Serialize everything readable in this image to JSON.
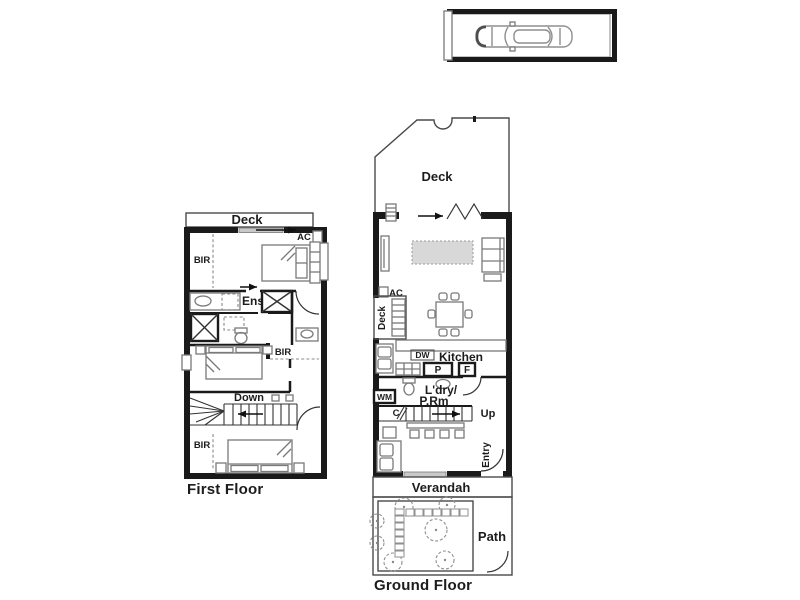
{
  "colors": {
    "wall": "#1a1a1a",
    "outline": "#4a4a4a",
    "furn": "#7a7a7a",
    "rug": "#d8d8d8",
    "slider": "#c9c9c9",
    "text": "#1c1c1c",
    "bg": "#ffffff"
  },
  "first_floor": {
    "title": "First Floor",
    "deck": "Deck",
    "bir_top": "BIR",
    "ac": "AC",
    "ens": "Ens",
    "bir_mid": "BIR",
    "down": "Down",
    "bir_bottom": "BIR"
  },
  "ground_floor": {
    "title": "Ground Floor",
    "deck_top": "Deck",
    "deck_side": "Deck",
    "ac": "AC",
    "dw": "DW",
    "kitchen": "Kitchen",
    "pantry": "P",
    "fridge": "F",
    "wm": "WM",
    "laundry_line1": "L'dry/",
    "laundry_line2": "P.Rm",
    "cupboard": "C",
    "up": "Up",
    "entry": "Entry",
    "verandah": "Verandah",
    "path": "Path"
  }
}
